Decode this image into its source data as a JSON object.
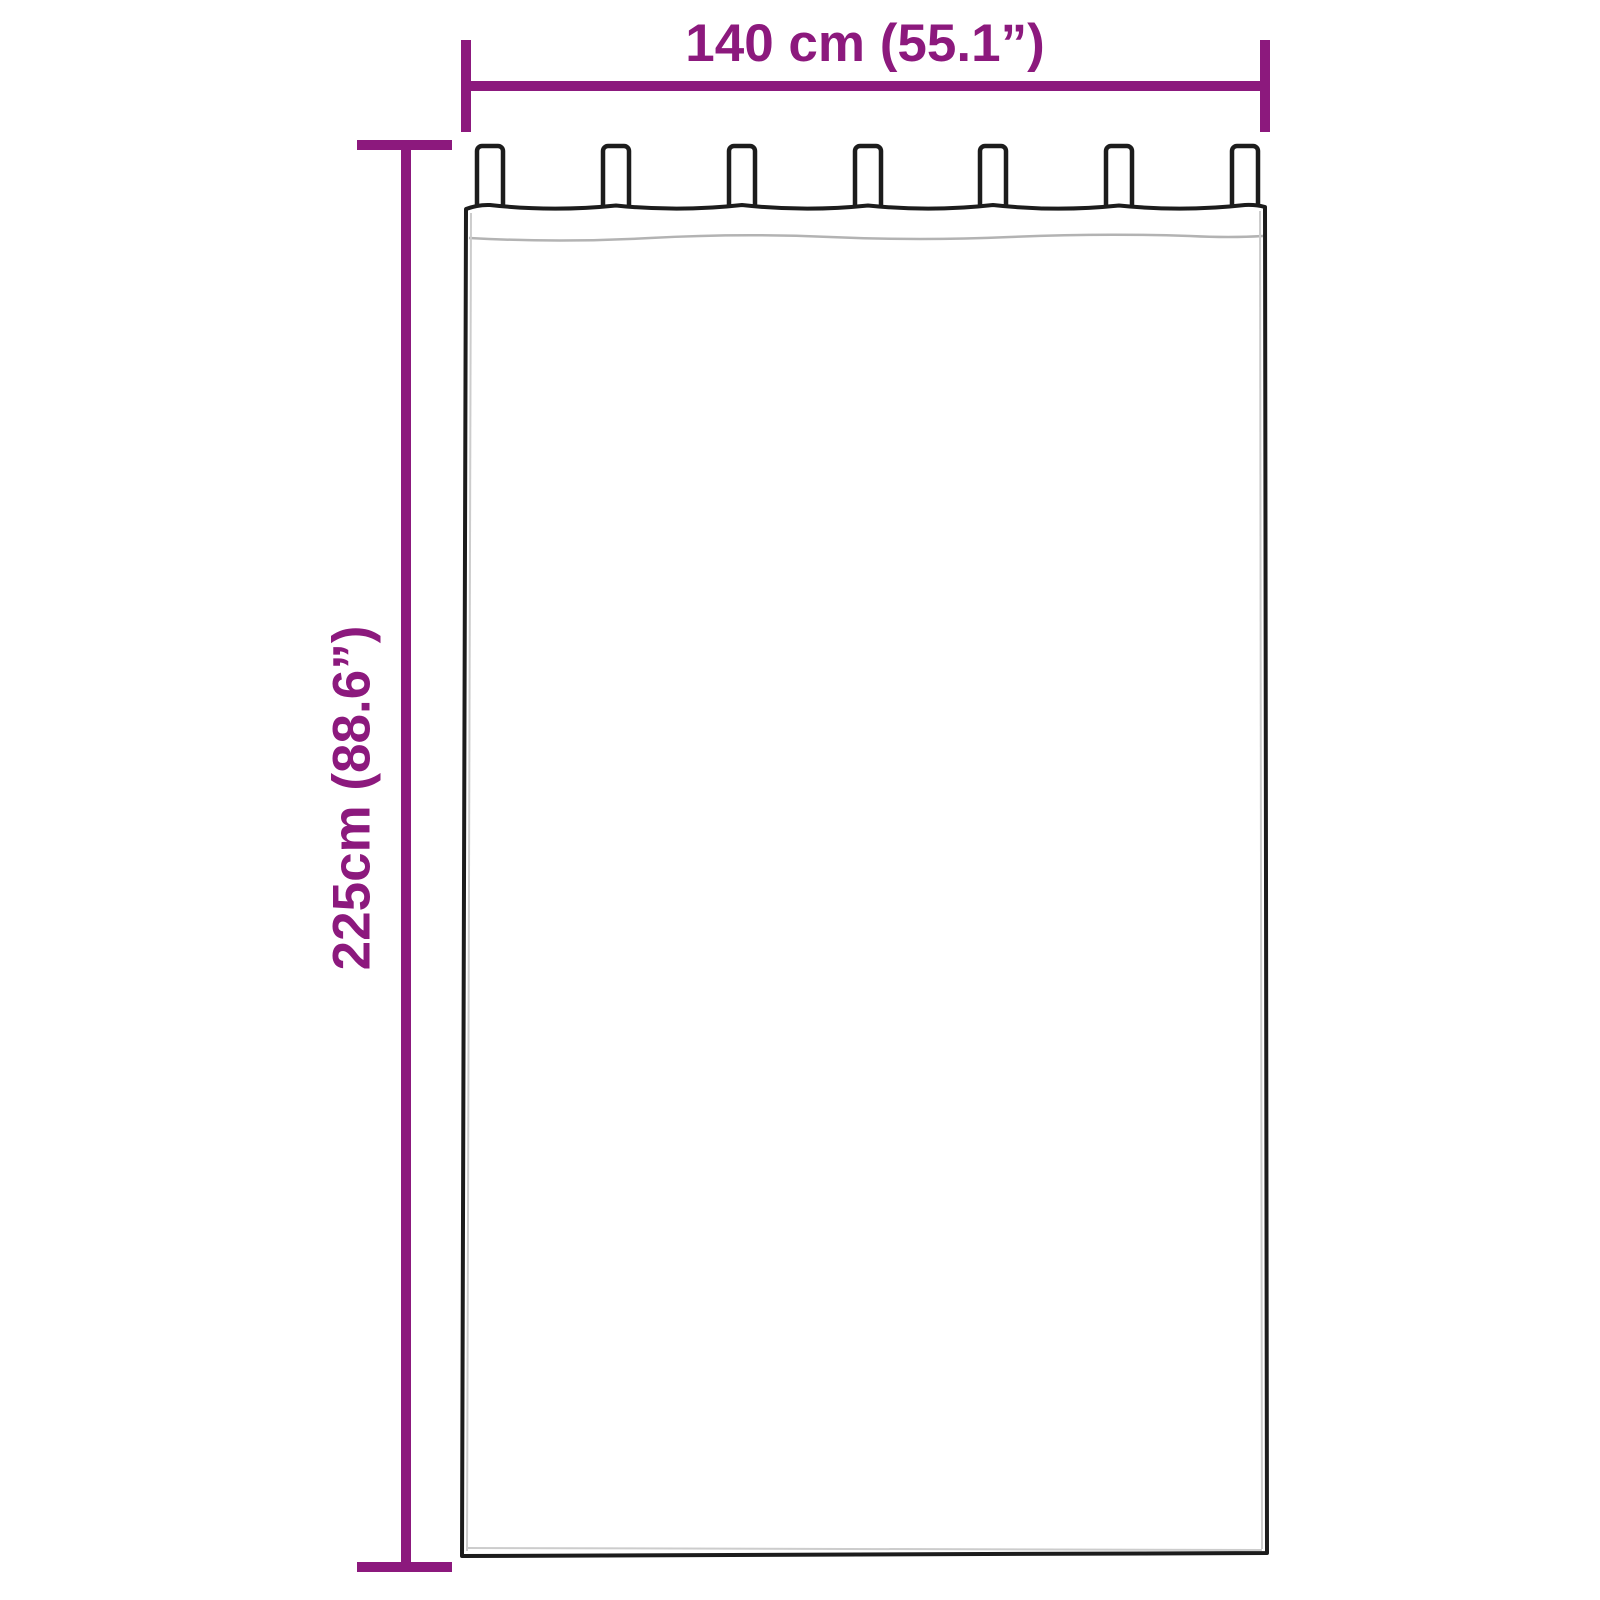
{
  "diagram": {
    "type": "curtain-dimension-diagram",
    "accent_color": "#8C197D",
    "outline_color": "#1c1c1c",
    "seam_color": "#b3b3b3",
    "tab_count": 7
  },
  "dimensions": {
    "width_label": "140 cm (55.1”)",
    "width_cm": "140",
    "width_inches": "55.1",
    "height_label": "225cm (88.6”)",
    "height_cm": "225",
    "height_inches": "88.6"
  }
}
